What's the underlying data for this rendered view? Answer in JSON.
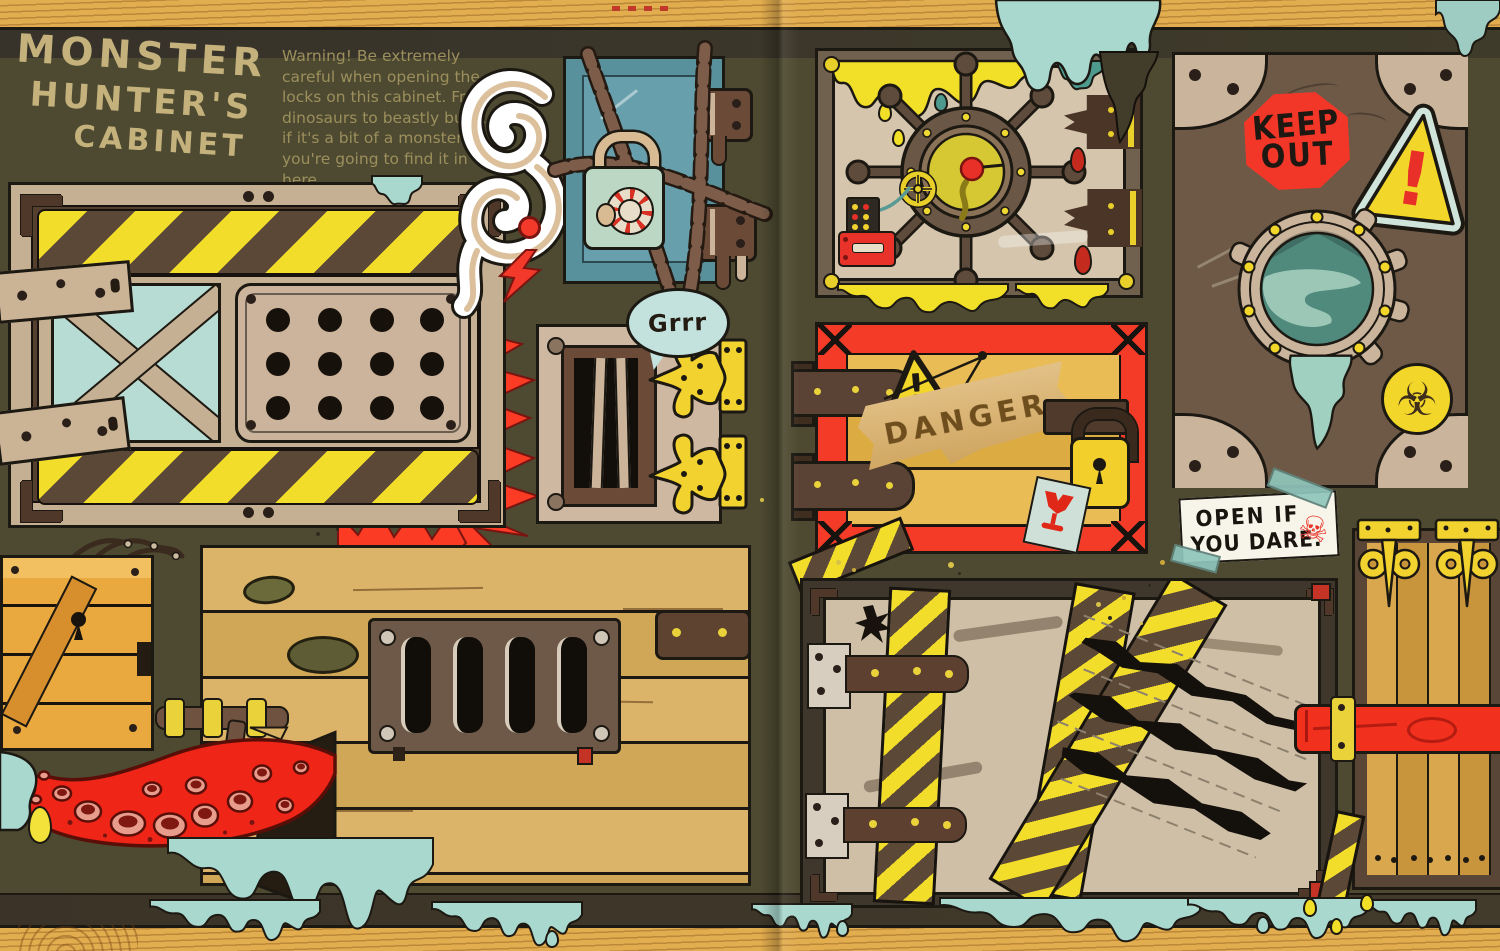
{
  "title": {
    "line1": "MONSTER",
    "line2": "HUNTER'S",
    "line3": "CABINET"
  },
  "intro": {
    "text": "Warning! Be extremely careful when opening the locks on this cabinet. From dinosaurs to beastly bugs, if it's a bit of a monster, you're going to find it in here."
  },
  "labels": {
    "growl": "Grrr",
    "danger": "DANGER",
    "keep_out_line1": "KEEP",
    "keep_out_line2": "OUT",
    "note_line1": "OPEN IF",
    "note_line2": "YOU DARE.",
    "exclamation": "!",
    "biohazard_icon": "☣",
    "skull_icon": "☠"
  },
  "colors": {
    "background_olive": "#4d4a31",
    "wood_gold": "#e2ad4f",
    "dark_band": "#3a3428",
    "title_tan": "#c4b17b",
    "body_text_olive": "#9c8f5c",
    "danger_red": "#f43b28",
    "hazard_yellow": "#f2dd2a",
    "hazard_brown": "#5c4836",
    "chest_teal": "#58909c",
    "slime_blue": "#a9d8cf",
    "slime_yellow": "#f2e028",
    "lock_mint": "#bcd8c5",
    "bubble_blue": "#c3e2de",
    "door_brown": "#6e5947",
    "plank_gold": "#d9a84e",
    "face_tan": "#cfbfa6",
    "keep_out_red": "#f23728",
    "tentacle_red": "#ee2517",
    "hinge_yellow": "#f2d22e",
    "porthole_teal": "#4f8a7d"
  }
}
